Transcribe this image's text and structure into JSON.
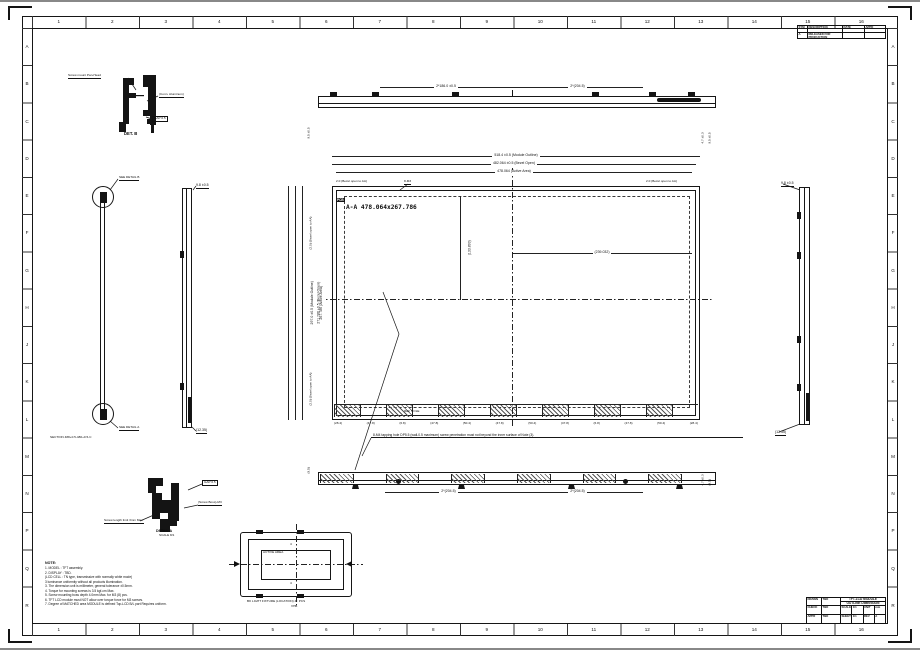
{
  "sheet": {
    "cols": [
      "1",
      "2",
      "3",
      "4",
      "5",
      "6",
      "7",
      "8",
      "9",
      "10",
      "11",
      "12",
      "13",
      "14",
      "15",
      "16"
    ],
    "rows": [
      "A",
      "B",
      "C",
      "D",
      "E",
      "F",
      "G",
      "H",
      "J",
      "K",
      "L",
      "M",
      "N",
      "P",
      "Q",
      "R"
    ]
  },
  "rev_table": {
    "c1": "SYM",
    "c2": "DESCRIPTION",
    "c3": "DATE",
    "c4": "APPD",
    "r1": "A",
    "r2": "RELEASED FOR PRODUCTION",
    "r3": "",
    "r4": ""
  },
  "title_block": {
    "drawn_label": "DRAWN",
    "check_label": "CHECK",
    "appr_label": "APPR",
    "drawn": "TBD",
    "check": "TBD",
    "appr": "TBD",
    "title1": "TFT-LCD MODULE",
    "title2": "OUTLINE DIMENSION",
    "scale_label": "SCALE",
    "scale": "1/1",
    "unit_label": "UNIT",
    "unit": "mm",
    "sheet_label": "SHEET",
    "sheet": "1/1",
    "rev_label": "REV",
    "rev": "A"
  },
  "det_b": {
    "label_mount": "Screw mount Pan-Head",
    "label_frame": "(Conn. Aluminum)",
    "label_gap": "GAP 0.5",
    "caption": "DET. B"
  },
  "det_a": {
    "label_gap": "GAP 0.5",
    "label_boss": "(Screw Boss)-M3",
    "label_screw": "Screw length limit 3mm Max.",
    "caption1": "DETAIL A",
    "caption2": "SCALE 8/1"
  },
  "section_view": {
    "label_top": "SEE DETAIL B",
    "label_bottom": "SEE DETAIL A",
    "caption": "SECTION 488+0.5-480+0.5-C"
  },
  "side_left": {
    "top_label": "9.8 ±0.5",
    "bottom_label": "(12.35)"
  },
  "side_right": {
    "top_label": "9.8 ±0.5",
    "bottom_label": "(12.35)"
  },
  "top_view": {
    "dim_left": "2*186.0 ±0.5",
    "dim_right": "2*(204.5)",
    "rot_left": "9.5 ±0.5",
    "rot_right1": "4.7 ±0.3",
    "rot_right2": "9.5 ±0.5"
  },
  "bottom_view": {
    "dim_left": "2*(204.5)",
    "dim_right": "2*(204.5)",
    "rot_left": "(9.5)",
    "rot_right1": "4.7 ±0.3",
    "rot_right2": "(9.5)",
    "note": "8-M4 tapping hole DP5.5 (wall-0.5 maximum) screw penetration must not beyond the inner surface of Note (3)."
  },
  "front_view": {
    "aa_label": "A-A  478.064x267.786",
    "pcb_label": "PCB",
    "dim_module": "518.4 ±0.5  (Module Outline)",
    "dim_bezel": "482.064 ±0.5  (Bezel Open)",
    "dim_active": "478.064  (Active Area)",
    "ldim_module": "297.0 ±0.5  (Module Outline)",
    "ldim_bezel": "271.786 ±0.5  (Bezel Open)",
    "ldim_active": "267.786  (Active Area)",
    "small_tl": "2.0 (Bezel open to AA)",
    "small_tm": "8-M3",
    "small_tr": "2.0 (Bezel open to AA)",
    "small_lt": "(2.0) (Bezel open to AA)",
    "small_lb": "(2.0) (Bezel open to AA)",
    "half_w": "(239.032)",
    "half_h": "(133.893)",
    "ref_hole": "REF HOLE",
    "hatch_values": [
      "(28.4)",
      "(47.8)",
      "(6.8)",
      "(47.8)",
      "(50.4)",
      "(47.8)",
      "(50.4)",
      "(47.8)",
      "(6.8)",
      "(47.8)",
      "(50.4)",
      "(28.4)"
    ]
  },
  "fixture_view": {
    "active_label": "ACTIVE AREA",
    "mark_top": "4",
    "mark_bottom": "4",
    "caption1": "BK LIGHT FIXTURE (LOCATION)  4 : PCS",
    "caption2": "VHB"
  },
  "notes": {
    "title": "NOTE:",
    "items": [
      "1. MODEL : TFT assembly.",
      "2. DISPLAY : TBD.",
      "   (LCD CELL : TN type, transmissive with normally white mode)",
      "   3 luminance uniformity without all products illumination.",
      "3. The dimension unit is millimeter, general tolerance ±0.5mm.",
      "4. Torque for mounting screws is 3.5 kgf-cm Max.",
      "5. Screw mounting boss depth 4.0mm Max. for M3 (8) pcs.",
      "6. TFT LCD module must NOT allow over torque force for M3 screws.",
      "7. Degree of MATCHED area MODULE is defined Top-LCD B/L part Requires uniform."
    ]
  }
}
